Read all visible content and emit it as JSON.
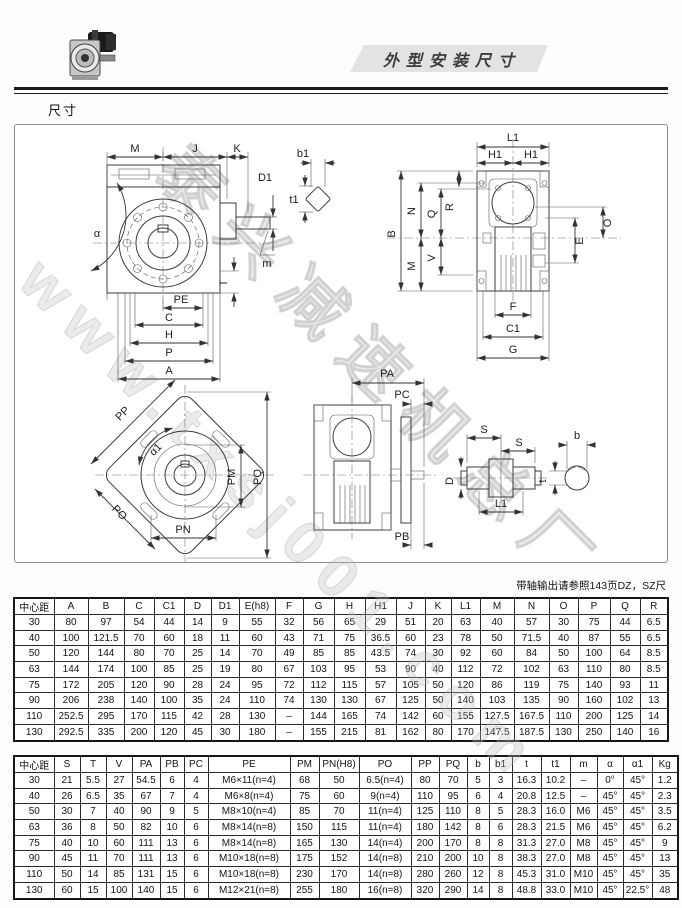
{
  "page": {
    "title": "外型安装尺寸",
    "section_label": "尺寸",
    "note": "带轴输出请参照143页DZ，SZ尺",
    "watermark_lines": [
      "www.txsj001.com",
      "泰兴减速机总厂"
    ]
  },
  "labels": {
    "M": "M",
    "J": "J",
    "K": "K",
    "D1": "D1",
    "b1": "b1",
    "t1": "t1",
    "alpha": "α",
    "m": "m",
    "T": "T",
    "PE": "PE",
    "C": "C",
    "H": "H",
    "P": "P",
    "A": "A",
    "L1": "L1",
    "H1": "H1",
    "B": "B",
    "N": "N",
    "Q": "Q",
    "R": "R",
    "V": "V",
    "O": "O",
    "E": "E",
    "F": "F",
    "C1": "C1",
    "G": "G",
    "PA": "PA",
    "PC": "PC",
    "PB": "PB",
    "PP": "PP",
    "alpha1": "α1",
    "PO": "PO",
    "PM": "PM",
    "PQ": "PQ",
    "PN": "PN",
    "S": "S",
    "D": "D",
    "b": "b",
    "t": "t"
  },
  "table1": {
    "headers": [
      "中心距",
      "A",
      "B",
      "C",
      "C1",
      "D",
      "D1",
      "E(h8)",
      "F",
      "G",
      "H",
      "H1",
      "J",
      "K",
      "L1",
      "M",
      "N",
      "O",
      "P",
      "Q",
      "R"
    ],
    "rows": [
      [
        "30",
        "80",
        "97",
        "54",
        "44",
        "14",
        "9",
        "55",
        "32",
        "56",
        "65",
        "29",
        "51",
        "20",
        "63",
        "40",
        "57",
        "30",
        "75",
        "44",
        "6.5"
      ],
      [
        "40",
        "100",
        "121.5",
        "70",
        "60",
        "18",
        "11",
        "60",
        "43",
        "71",
        "75",
        "36.5",
        "60",
        "23",
        "78",
        "50",
        "71.5",
        "40",
        "87",
        "55",
        "6.5"
      ],
      [
        "50",
        "120",
        "144",
        "80",
        "70",
        "25",
        "14",
        "70",
        "49",
        "85",
        "85",
        "43.5",
        "74",
        "30",
        "92",
        "60",
        "84",
        "50",
        "100",
        "64",
        "8.5"
      ],
      [
        "63",
        "144",
        "174",
        "100",
        "85",
        "25",
        "19",
        "80",
        "67",
        "103",
        "95",
        "53",
        "90",
        "40",
        "112",
        "72",
        "102",
        "63",
        "110",
        "80",
        "8.5"
      ],
      [
        "75",
        "172",
        "205",
        "120",
        "90",
        "28",
        "24",
        "95",
        "72",
        "112",
        "115",
        "57",
        "105",
        "50",
        "120",
        "86",
        "119",
        "75",
        "140",
        "93",
        "11"
      ],
      [
        "90",
        "206",
        "238",
        "140",
        "100",
        "35",
        "24",
        "110",
        "74",
        "130",
        "130",
        "67",
        "125",
        "50",
        "140",
        "103",
        "135",
        "90",
        "160",
        "102",
        "13"
      ],
      [
        "110",
        "252.5",
        "295",
        "170",
        "115",
        "42",
        "28",
        "130",
        "–",
        "144",
        "165",
        "74",
        "142",
        "60",
        "155",
        "127.5",
        "167.5",
        "110",
        "200",
        "125",
        "14"
      ],
      [
        "130",
        "292.5",
        "335",
        "200",
        "120",
        "45",
        "30",
        "180",
        "–",
        "155",
        "215",
        "81",
        "162",
        "80",
        "170",
        "147.5",
        "187.5",
        "130",
        "250",
        "140",
        "16"
      ]
    ]
  },
  "table2": {
    "headers": [
      "中心距",
      "S",
      "T",
      "V",
      "PA",
      "PB",
      "PC",
      "PE",
      "PM",
      "PN(H8)",
      "PO",
      "PP",
      "PQ",
      "b",
      "b1",
      "t",
      "t1",
      "m",
      "α",
      "α1",
      "Kg"
    ],
    "rows": [
      [
        "30",
        "21",
        "5.5",
        "27",
        "54.5",
        "6",
        "4",
        "M6×11(n=4)",
        "68",
        "50",
        "6.5(n=4)",
        "80",
        "70",
        "5",
        "3",
        "16.3",
        "10.2",
        "–",
        "0°",
        "45°",
        "1.2"
      ],
      [
        "40",
        "26",
        "6.5",
        "35",
        "67",
        "7",
        "4",
        "M6×8(n=4)",
        "75",
        "60",
        "9(n=4)",
        "110",
        "95",
        "6",
        "4",
        "20.8",
        "12.5",
        "–",
        "45°",
        "45°",
        "2.3"
      ],
      [
        "50",
        "30",
        "7",
        "40",
        "90",
        "9",
        "5",
        "M8×10(n=4)",
        "85",
        "70",
        "11(n=4)",
        "125",
        "110",
        "8",
        "5",
        "28.3",
        "16.0",
        "M6",
        "45°",
        "45°",
        "3.5"
      ],
      [
        "63",
        "36",
        "8",
        "50",
        "82",
        "10",
        "6",
        "M8×14(n=8)",
        "150",
        "115",
        "11(n=4)",
        "180",
        "142",
        "8",
        "6",
        "28.3",
        "21.5",
        "M6",
        "45°",
        "45°",
        "6.2"
      ],
      [
        "75",
        "40",
        "10",
        "60",
        "111",
        "13",
        "6",
        "M8×14(n=8)",
        "165",
        "130",
        "14(n=4)",
        "200",
        "170",
        "8",
        "8",
        "31.3",
        "27.0",
        "M8",
        "45°",
        "45°",
        "9"
      ],
      [
        "90",
        "45",
        "11",
        "70",
        "111",
        "13",
        "6",
        "M10×18(n=8)",
        "175",
        "152",
        "14(n=8)",
        "210",
        "200",
        "10",
        "8",
        "38.3",
        "27.0",
        "M8",
        "45°",
        "45°",
        "13"
      ],
      [
        "110",
        "50",
        "14",
        "85",
        "131",
        "15",
        "6",
        "M10×18(n=8)",
        "230",
        "170",
        "14(n=8)",
        "280",
        "260",
        "12",
        "8",
        "45.3",
        "31.0",
        "M10",
        "45°",
        "45°",
        "35"
      ],
      [
        "130",
        "60",
        "15",
        "100",
        "140",
        "15",
        "6",
        "M12×21(n=8)",
        "255",
        "180",
        "16(n=8)",
        "320",
        "290",
        "14",
        "8",
        "48.8",
        "33.0",
        "M10",
        "45°",
        "22.5°",
        "48"
      ]
    ]
  }
}
